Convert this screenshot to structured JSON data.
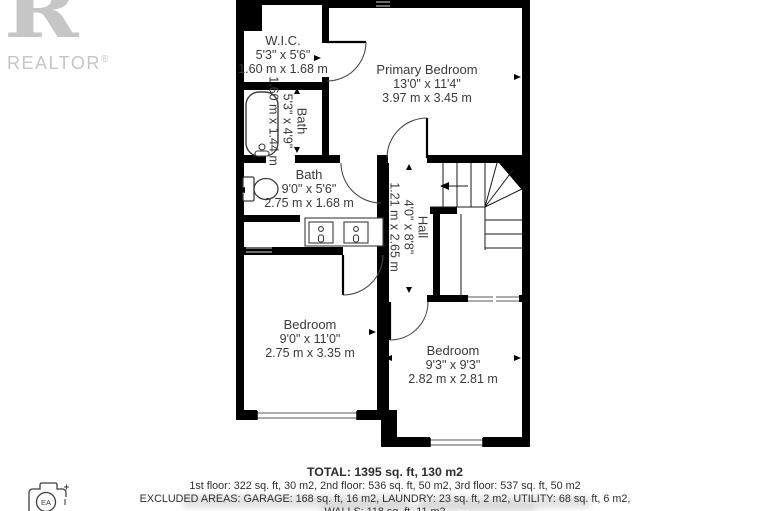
{
  "branding": {
    "logo_letter": "R",
    "logo_word": "REALTOR",
    "registered_mark": "®"
  },
  "camera_badge": "EA",
  "rooms": {
    "wic": {
      "name": "W.I.C.",
      "imperial": "5'3\" x 5'6\"",
      "metric": "1.60 m x 1.68 m"
    },
    "primary_bedroom": {
      "name": "Primary Bedroom",
      "imperial": "13'0\" x 11'4\"",
      "metric": "3.97 m x 3.45 m"
    },
    "ensuite_bath": {
      "name": "Bath",
      "imperial": "5'3\" x 4'9\"",
      "metric": "1.60 m x 1.44 m"
    },
    "main_bath": {
      "name": "Bath",
      "imperial": "9'0\" x 5'6\"",
      "metric": "2.75 m x 1.68 m"
    },
    "hall": {
      "name": "Hall",
      "imperial": "4'0\" x 8'8\"",
      "metric": "1.21 m x 2.65 m"
    },
    "bedroom_left": {
      "name": "Bedroom",
      "imperial": "9'0\" x 11'0\"",
      "metric": "2.75 m x 3.35 m"
    },
    "bedroom_right": {
      "name": "Bedroom",
      "imperial": "9'3\" x 9'3\"",
      "metric": "2.82 m x 2.81 m"
    }
  },
  "summary": {
    "total": "TOTAL: 1395 sq. ft, 130 m2",
    "floors": "1st floor: 322 sq. ft, 30 m2, 2nd floor: 536 sq. ft, 50 m2, 3rd floor: 537 sq. ft, 50 m2",
    "excluded_areas": "EXCLUDED AREAS: GARAGE: 168 sq. ft, 16 m2, LAUNDRY: 23 sq. ft, 2 m2, UTILITY: 68 sq. ft, 6 m2,",
    "walls": "WALLS: 118 sq. ft, 11 m2"
  },
  "colors": {
    "wall": "#000000",
    "text": "#3a3a3a",
    "logo_gray": "#c6c6c6",
    "window_gray": "#8f8f8f"
  }
}
